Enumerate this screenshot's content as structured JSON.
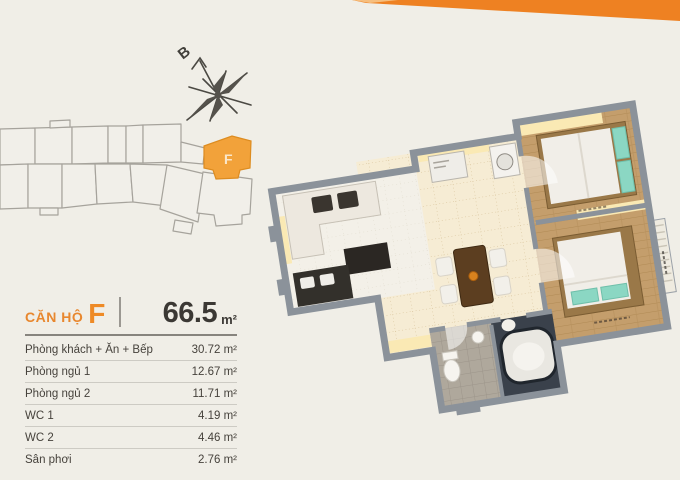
{
  "page": {
    "background_color": "#F0EEE7",
    "accent_orange": "#EE8122"
  },
  "ribbon": {
    "color": "#EE8122"
  },
  "compass": {
    "north_label": "B"
  },
  "keyplan": {
    "highlighted_unit_label": "F",
    "highlight_color": "#F2A23A",
    "outline_color": "#A6A39C"
  },
  "unit_info": {
    "title_prefix": "CĂN HỘ",
    "unit_label": "F",
    "total_area_value": "66.5",
    "total_area_unit": "m²",
    "rows": [
      {
        "label": "Phòng khách + Ăn + Bếp",
        "value": "30.72 m²"
      },
      {
        "label": "Phòng ngủ 1",
        "value": "12.67 m²"
      },
      {
        "label": "Phòng ngủ 2",
        "value": "11.71 m²"
      },
      {
        "label": "WC 1",
        "value": "4.19 m²"
      },
      {
        "label": "WC 2",
        "value": "4.46 m²"
      },
      {
        "label": "Sân phơi",
        "value": "2.76 m²"
      }
    ]
  },
  "floor_plan": {
    "wall_color": "#8B929A",
    "tile_color": "#F6ECD4",
    "wood_color": "#C49E6C",
    "teal_color": "#8BD7C3",
    "wc_dark_floor": "#3A414B",
    "glow_color": "#FAE9B4"
  }
}
